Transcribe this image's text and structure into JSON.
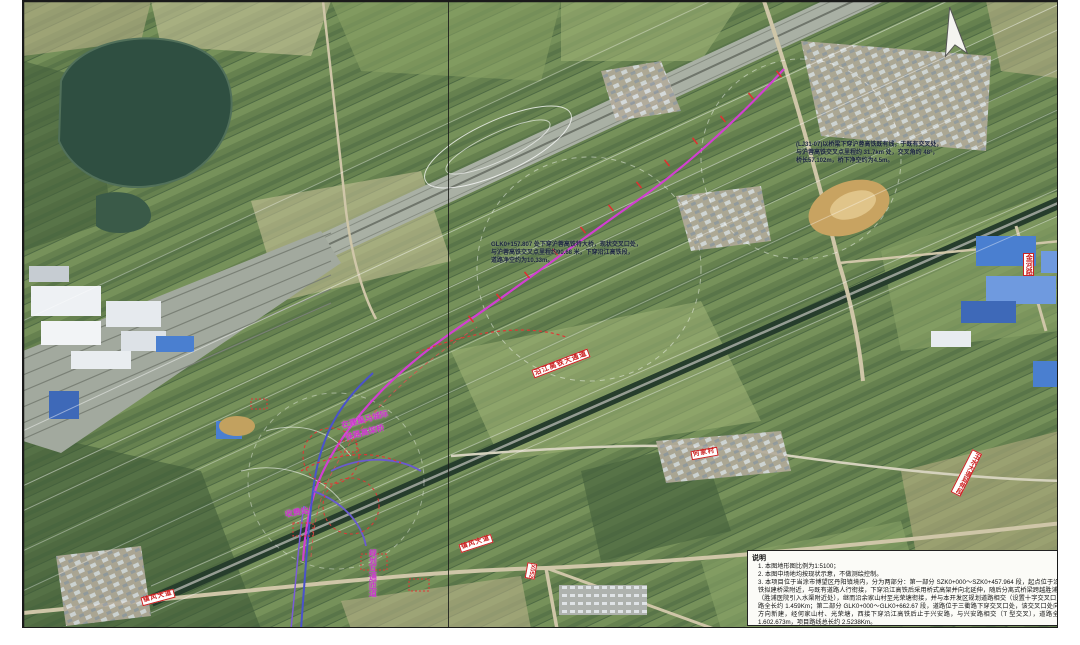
{
  "annotations": {
    "top_right": {
      "lines": [
        "(LJ31-07)以桥梁下穿沪蓉高铁既有线，于既有交叉处，",
        "与沪蓉高铁交叉点里程约 31.7km 处，交叉角约 48°，",
        "桥长57.102m，桥下净空约为4.5m。"
      ]
    },
    "mid": {
      "lines": [
        "GLK0+157.807 处下穿沪蓉高铁特大桥，现状交叉口处，",
        "与沪蓉高铁交叉点里程约90.68 米，下穿沿江高铁段，",
        "道路净空约为10.33m。"
      ]
    },
    "notes": {
      "title": "说明",
      "items": [
        "1. 本图地形图比例为1:5100；",
        "2. 本图中场地均按现状示意，不做测绘控制。",
        "3. 本项目位于当涂市博望区丹阳镇境内，分为两部分：第一部分 SZK0+000～SZK0+457.964 段，起点位于沿江高铁拟建桥梁附近，与既有道路人行衔接，下穿沿江高铁后采用桥式高架并向北延伸，随后分离式桥梁跨越胜浦河D1（胜浦医院引入水渠附近处），继而沿余家山村至光荣塘衔接，并与本开发区规划道路相交（设置十字交叉口），道路全长约 1.459Km；第二部分 GLK0+000～GLK0+662.67 段，道路位于三衢路下穿交叉口处，该交叉口处向东北方向新建，经何家山村、光荣塘，西接下穿沿江高铁后止于兴安路，与兴安路相交（T 型交叉），道路全长约 1.602.673m，项目路线总长约 2.5238Km。"
      ]
    }
  },
  "labels": {
    "rail_corridor": "沿江高铁大通道",
    "road_ext": "玉水大道延伸段",
    "jinhe_road": "金河路",
    "zhenfeng_1": "镇风大道",
    "zhenfeng_2": "镇风大道",
    "x052": "X052",
    "village": "何家村",
    "construction_line1": "在建巢马城际",
    "construction_line2": "铁路高架桥",
    "toll": "收费站",
    "planned_ramp": "规划互通匝道"
  },
  "colors": {
    "alignment_magenta": "#d23fd2",
    "chainage_tick_red": "#e03030",
    "road_label_red": "#cc2222",
    "construction_magenta": "#cc33cc",
    "annotation_text": "#1b2440"
  }
}
